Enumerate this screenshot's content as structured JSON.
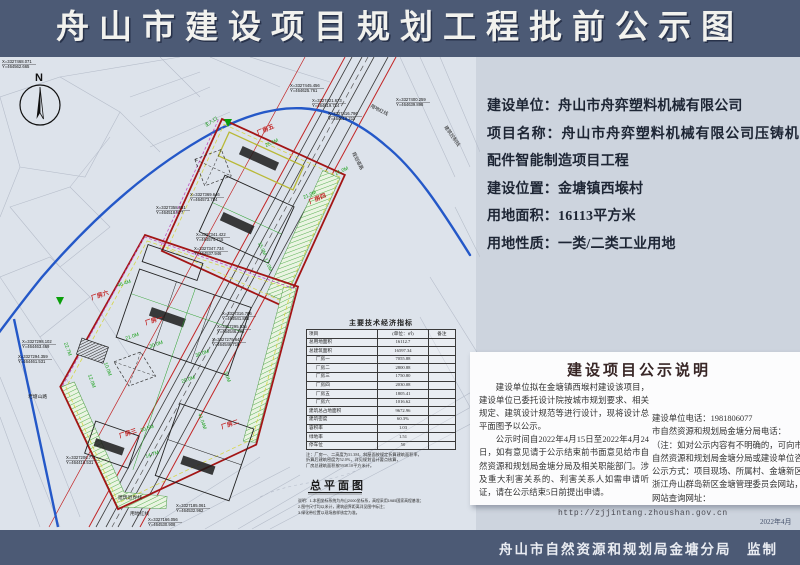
{
  "header": {
    "title": "舟山市建设项目规划工程批前公示图"
  },
  "footer": {
    "text": "舟山市自然资源和规划局金塘分局　监制",
    "year": "2022年4月"
  },
  "info": {
    "lines": [
      "建设单位：舟山市舟弈塑料机械有限公司",
      "项目名称：舟山市舟弈塑料机械有限公司压铸机配件智能制造项目工程",
      "建设位置：金塘镇西堠村",
      "用地面积：16113平方米",
      "用地性质：一类/二类工业用地"
    ]
  },
  "notice": {
    "title": "建设项目公示说明",
    "left_paragraphs": [
      "建设单位拟在金塘镇西堠村建设该项目，建设单位已委托设计院按城市规划要求、相关规定、建筑设计规范等进行设计，现将设计总平面图予以公示。",
      "公示时间自2022年4月15日至2022年4月24日，如有意见请于公示结束前书面意见给市自然资源和规划局金塘分局及相关职能部门。涉及重大利害关系的、利害关系人如需申请听证，请在公示结束5日前提出申请。"
    ],
    "right_lines": [
      "建设单位电话：1981806077",
      "市自然资源和规划局金塘分局电话：",
      "（注：如对公示内容有不明确的，可向市",
      "自然资源和规划局金塘分局或建设单位咨",
      "公示方式：项目现场、所属村、金塘新区",
      "浙江舟山群岛新区金塘管理委员会网站，",
      "网站查询网址："
    ],
    "url": "http://zjjintang.zhoushan.gov.cn"
  },
  "map": {
    "north_label": "N",
    "plan_title": "总平面图",
    "plan_notes": [
      "说明：1.本图坐标系统为舟山2000坐标系，高程采用1985国家高程基准；",
      "2.图中尺寸均以米计，建筑退界距离详见图中标注；",
      "3.绿化带位置以现场放样核定为准。"
    ],
    "table": {
      "title": "主要技术经济指标",
      "header": [
        "项目",
        "(单位：㎡)",
        "备注"
      ],
      "rows": [
        {
          "label": "总用地面积",
          "value": "16112.7",
          "group": false
        },
        {
          "label": "总建筑面积",
          "value": "16597.34",
          "group": false
        },
        {
          "label": "厂房一",
          "value": "7055.88",
          "group": true
        },
        {
          "label": "厂房二",
          "value": "2800.88",
          "group": true
        },
        {
          "label": "厂房三",
          "value": "1750.80",
          "group": true
        },
        {
          "label": "厂房四",
          "value": "2030.08",
          "group": true
        },
        {
          "label": "厂房五",
          "value": "1805.41",
          "group": true
        },
        {
          "label": "厂房六",
          "value": "1016.62",
          "group": true
        },
        {
          "label": "建筑总占地面积",
          "value": "9672.96",
          "group": false
        },
        {
          "label": "建筑密度",
          "value": "60.3%",
          "group": false
        },
        {
          "label": "容积率",
          "value": "1.03",
          "group": false
        },
        {
          "label": "绿地率",
          "value": "1.51",
          "group": false
        },
        {
          "label": "停车位",
          "value": "50",
          "group": false
        }
      ],
      "notes": [
        "注：厂房一、二高度为31.3M，斜屋面按规定折算建筑面积率，",
        "折算后建筑密度为52.0%，详见规划设计要点核算，",
        "厂房总建筑面积按5938.10平方米计。"
      ]
    },
    "building_labels": [
      {
        "t": "厂房五",
        "x": 258,
        "y": 78,
        "r": -24
      },
      {
        "t": "厂房四",
        "x": 310,
        "y": 147,
        "r": -24
      },
      {
        "t": "厂房六",
        "x": 92,
        "y": 243,
        "r": -19
      },
      {
        "t": "厂房一",
        "x": 146,
        "y": 268,
        "r": -19
      },
      {
        "t": "厂房三",
        "x": 120,
        "y": 381,
        "r": -19
      },
      {
        "t": "厂房二",
        "x": 222,
        "y": 372,
        "r": -19
      }
    ],
    "dim_labels": [
      {
        "t": "25.5M",
        "x": 266,
        "y": 90,
        "r": -24
      },
      {
        "t": "21.0M",
        "x": 336,
        "y": 118,
        "r": -24
      },
      {
        "t": "21.0M",
        "x": 304,
        "y": 142,
        "r": -24
      },
      {
        "t": "15.0M",
        "x": 258,
        "y": 186,
        "r": 66
      },
      {
        "t": "17.0M",
        "x": 264,
        "y": 202,
        "r": 66
      },
      {
        "t": "46.4M",
        "x": 118,
        "y": 230,
        "r": -19
      },
      {
        "t": "22.7M",
        "x": 64,
        "y": 286,
        "r": 70
      },
      {
        "t": "30.0M",
        "x": 150,
        "y": 291,
        "r": -19
      },
      {
        "t": "21.0M",
        "x": 126,
        "y": 283,
        "r": -19
      },
      {
        "t": "10.0M",
        "x": 104,
        "y": 306,
        "r": 70
      },
      {
        "t": "12.0M",
        "x": 88,
        "y": 318,
        "r": 70
      },
      {
        "t": "20.0M",
        "x": 182,
        "y": 326,
        "r": -19
      },
      {
        "t": "41.04M",
        "x": 198,
        "y": 357,
        "r": 70
      },
      {
        "t": "30.5M",
        "x": 141,
        "y": 375,
        "r": -19
      },
      {
        "t": "14.7M",
        "x": 146,
        "y": 401,
        "r": -19
      },
      {
        "t": "3.0M",
        "x": 224,
        "y": 315,
        "r": 70
      },
      {
        "t": "30.0M",
        "x": 196,
        "y": 300,
        "r": -19
      }
    ],
    "misc_labels": [
      {
        "t": "用地红线",
        "x": 370,
        "y": 50,
        "r": 27,
        "c": "#222222"
      },
      {
        "t": "建筑控制线",
        "x": 444,
        "y": 70,
        "r": 55,
        "c": "#222222"
      },
      {
        "t": "规划道路",
        "x": 352,
        "y": 96,
        "r": 63,
        "c": "#222222"
      },
      {
        "t": "老塘山路",
        "x": 28,
        "y": 341,
        "r": 0,
        "c": "#222222"
      },
      {
        "t": "建筑退界线",
        "x": 118,
        "y": 442,
        "r": 0,
        "c": "#222222"
      },
      {
        "t": "用地红线",
        "x": 130,
        "y": 458,
        "r": 0,
        "c": "#222222"
      },
      {
        "t": "主入口",
        "x": 206,
        "y": 70,
        "r": -33,
        "c": "#0a8f0a"
      }
    ],
    "coordinate_callouts": [
      {
        "x": 290,
        "y": 30,
        "X": "X=3327445.456",
        "Y": "Y=464625.761"
      },
      {
        "x": 312,
        "y": 45,
        "X": "X=3327421.673",
        "Y": "Y=464619.714"
      },
      {
        "x": 328,
        "y": 58,
        "X": "X=3327416.796",
        "Y": "Y=464610.211"
      },
      {
        "x": 396,
        "y": 44,
        "X": "X=3327400.259",
        "Y": "Y=464639.898"
      },
      {
        "x": 190,
        "y": 139,
        "X": "X=3327369.646",
        "Y": "Y=464573.784"
      },
      {
        "x": 156,
        "y": 152,
        "X": "X=3327358.651",
        "Y": "Y=464518.877"
      },
      {
        "x": 196,
        "y": 179,
        "X": "X=3327341.422",
        "Y": "Y=464574.715"
      },
      {
        "x": 194,
        "y": 193,
        "X": "X=3327347.734",
        "Y": "Y=464537.946"
      },
      {
        "x": 222,
        "y": 258,
        "X": "X=3327316.706",
        "Y": "Y=464541.882"
      },
      {
        "x": 217,
        "y": 271,
        "X": "X=3327295.535",
        "Y": "Y=464546.396"
      },
      {
        "x": 212,
        "y": 284,
        "X": "X=3327279.643",
        "Y": "Y=464546.718"
      },
      {
        "x": 22,
        "y": 286,
        "X": "X=3327298.102",
        "Y": "Y=464463.469"
      },
      {
        "x": 18,
        "y": 301,
        "X": "X=3327294.359",
        "Y": "Y=464461.531"
      },
      {
        "x": 66,
        "y": 402,
        "X": "X=3327206.771",
        "Y": "Y=464416.531"
      },
      {
        "x": 176,
        "y": 450,
        "X": "X=3327185.061",
        "Y": "Y=464532.962"
      },
      {
        "x": 148,
        "y": 464,
        "X": "X=3327166.056",
        "Y": "Y=464530.908"
      },
      {
        "x": 2,
        "y": 6,
        "X": "X=3327468.071",
        "Y": "Y=464562.665"
      }
    ]
  }
}
